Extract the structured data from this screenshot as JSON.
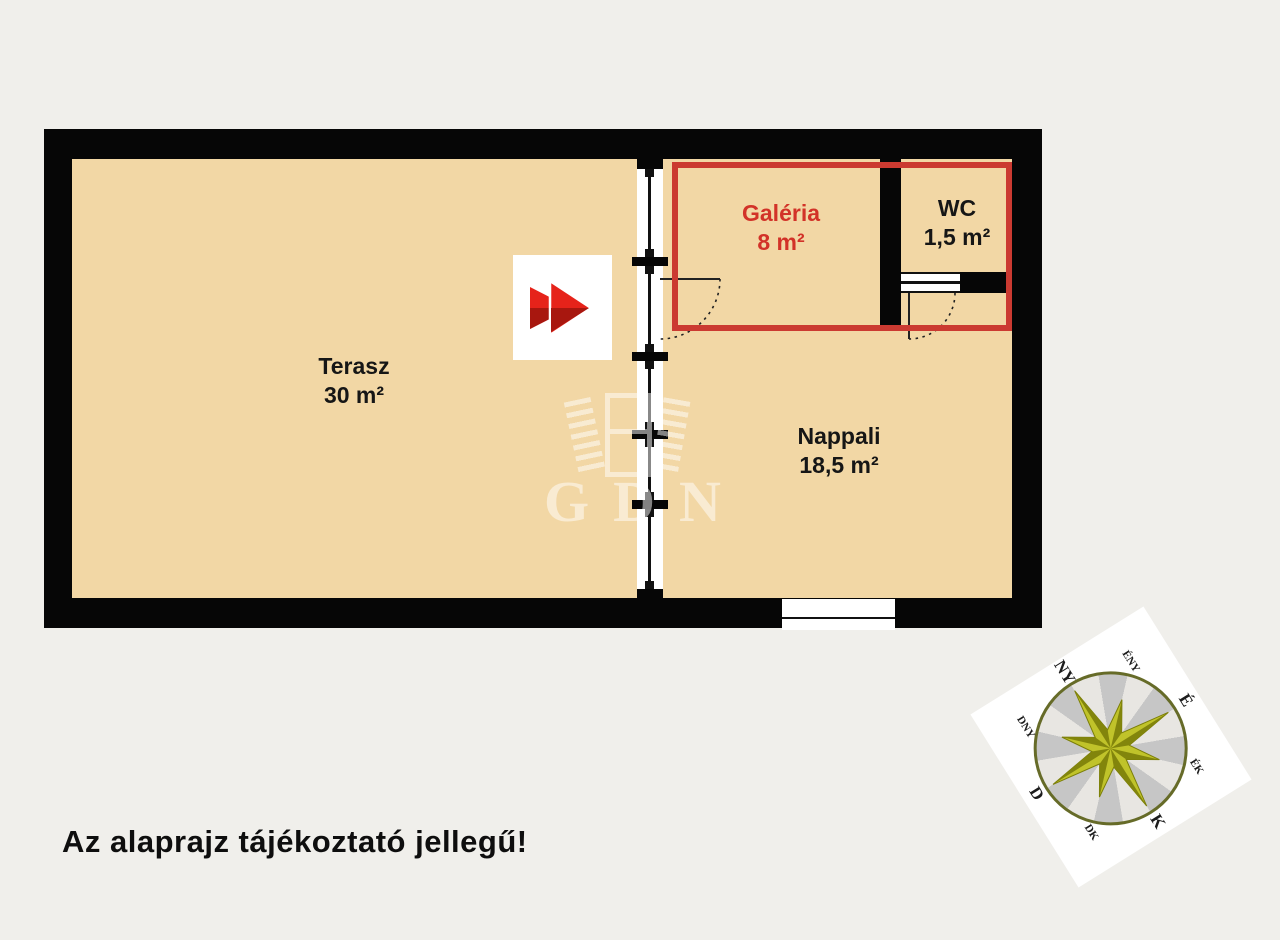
{
  "disclaimer": "Az alaprajz tájékoztató jellegű!",
  "floorplan": {
    "floor_color": "#f2d7a5",
    "wall_color": "#060606",
    "highlight_color": "#cb3a31",
    "rooms": [
      {
        "name": "Terasz",
        "area": "30 m²"
      },
      {
        "name": "Galéria",
        "area": "8 m²"
      },
      {
        "name": "WC",
        "area": "1,5 m²"
      },
      {
        "name": "Nappali",
        "area": "18,5 m²"
      }
    ]
  },
  "watermark": {
    "text": "GDN"
  },
  "compass": {
    "labels": {
      "n": "É",
      "ne": "ÉK",
      "e": "K",
      "se": "DK",
      "s": "D",
      "sw": "DNY",
      "w": "NY",
      "nw": "ÉNY"
    }
  }
}
